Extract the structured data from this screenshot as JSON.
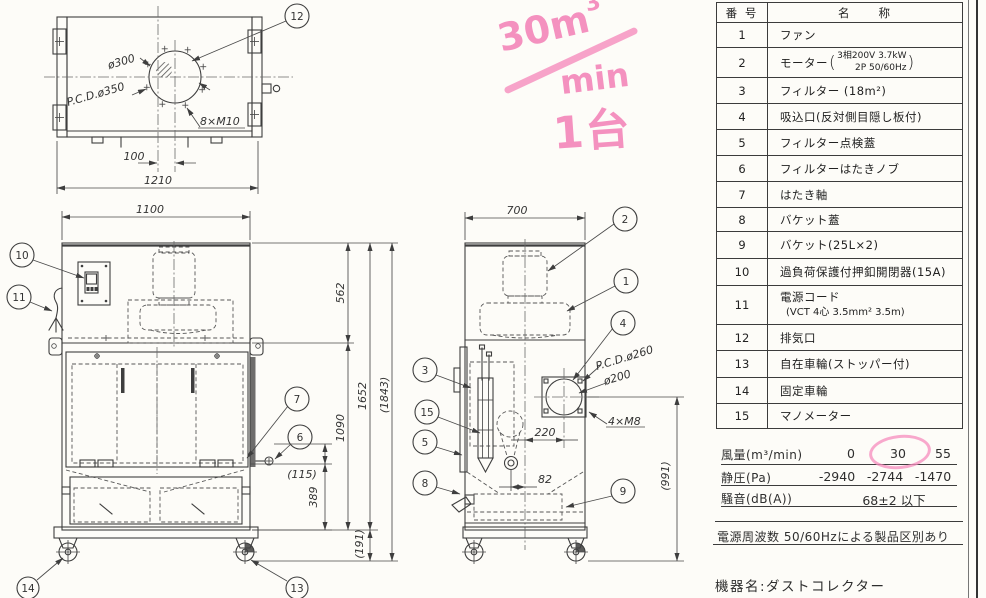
{
  "note": {
    "vol": "30m",
    "sup": "3",
    "den": "min",
    "qty": "1台"
  },
  "parts": {
    "title_no": "番 号",
    "title_name": "名　　称",
    "rows": [
      {
        "no": "1",
        "name": "ファン"
      },
      {
        "no": "2",
        "name": "モーター",
        "p1": "3相200V 3.7kW",
        "p2": "2P 50/60Hz"
      },
      {
        "no": "3",
        "name": "フィルター (18m²)"
      },
      {
        "no": "4",
        "name": "吸込口(反対側目隠し板付)"
      },
      {
        "no": "5",
        "name": "フィルター点検蓋"
      },
      {
        "no": "6",
        "name": "フィルターはたきノブ"
      },
      {
        "no": "7",
        "name": "はたき軸"
      },
      {
        "no": "8",
        "name": "バケット蓋"
      },
      {
        "no": "9",
        "name": "バケット(25L×2)"
      },
      {
        "no": "10",
        "name": "過負荷保護付押釦開閉器(15A)"
      },
      {
        "no": "11",
        "name": "電源コード",
        "sub": "(VCT 4心 3.5mm² 3.5m)"
      },
      {
        "no": "12",
        "name": "排気口"
      },
      {
        "no": "13",
        "name": "自在車輪(ストッパー付)"
      },
      {
        "no": "14",
        "name": "固定車輪"
      },
      {
        "no": "15",
        "name": "マノメーター"
      }
    ]
  },
  "spec": {
    "flow_label": "風量(m³/min)",
    "flow_v1": "0",
    "flow_v2": "30",
    "flow_v3": "55",
    "press_label": "静圧(Pa)",
    "press_v1": "-2940",
    "press_v2": "-2744",
    "press_v3": "-1470",
    "noise_label": "騒音(dB(A))",
    "noise_value": "68±2 以下",
    "freq_note": "電源周波数  50/60Hzによる製品区別あり",
    "device_name": "機器名:ダストコレクター"
  },
  "drawing": {
    "balloons": {
      "b1": "1",
      "b2": "2",
      "b3": "3",
      "b4": "4",
      "b5": "5",
      "b6": "6",
      "b7": "7",
      "b8": "8",
      "b9": "9",
      "b10": "10",
      "b11": "11",
      "b12": "12",
      "b13": "13",
      "b14": "14",
      "b15": "15"
    },
    "top": {
      "dia": "ø300",
      "pcd": "P.C.D.ø350",
      "bolts": "8×M10",
      "offset": "100",
      "width": "1210"
    },
    "front": {
      "width": "1100",
      "knob_h": "(115)",
      "door_h": "389"
    },
    "heights": {
      "upper": "562",
      "lower": "1090",
      "body": "1652",
      "overall": "(1843)",
      "base": "(191)"
    },
    "side": {
      "width": "700",
      "pcd": "P.C.D.ø260",
      "dia": "ø200",
      "bolts": "4×M8",
      "offset": "220",
      "drain": "82",
      "height": "(991)"
    }
  },
  "colors": {
    "pink": "#f37fb6",
    "line": "#3e3e3e",
    "paper": "#fdfcf8"
  }
}
